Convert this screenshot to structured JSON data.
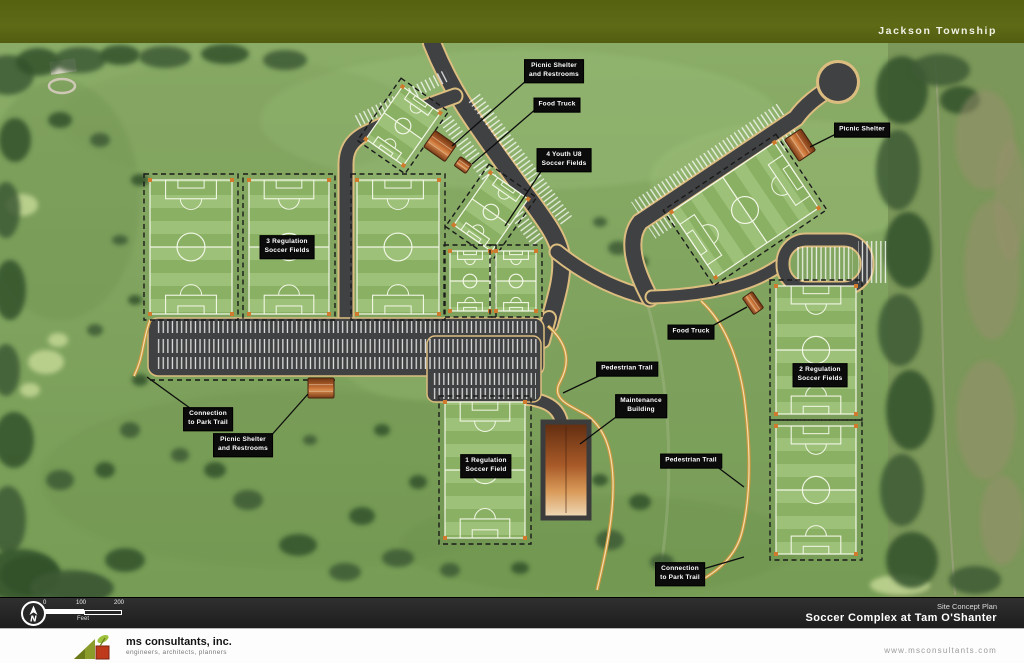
{
  "header": {
    "township_label": "Jackson Township"
  },
  "labels": {
    "picnic_shelter_restrooms_north": "Picnic Shelter\nand Restrooms",
    "food_truck_north": "Food Truck",
    "youth_u8_fields": "4 Youth U8\nSoccer Fields",
    "picnic_shelter_east": "Picnic Shelter",
    "regulation_fields_3": "3 Regulation\nSoccer Fields",
    "food_truck_east": "Food Truck",
    "regulation_fields_2": "2 Regulation\nSoccer Fields",
    "pedestrian_trail_mid": "Pedestrian Trail",
    "maintenance_building": "Maintenance\nBuilding",
    "pedestrian_trail_east": "Pedestrian Trail",
    "connection_park_trail_west": "Connection\nto Park Trail",
    "picnic_shelter_restrooms_west": "Picnic Shelter\nand Restrooms",
    "regulation_field_1": "1 Regulation\nSoccer Field",
    "connection_park_trail_south": "Connection\nto Park Trail"
  },
  "scale_bar": {
    "tick_zero": "0",
    "tick_hundred": "100",
    "tick_two_hundred": "200",
    "unit": "Feet",
    "north_letter": "N"
  },
  "title_block": {
    "plan_type": "Site Concept Plan",
    "project_name": "Soccer Complex at Tam O'Shanter"
  },
  "footer": {
    "company_name": "ms consultants, inc.",
    "company_tagline": "engineers, architects, planners",
    "website": "www.msconsultants.com"
  },
  "colors": {
    "header_olive": "#59641a",
    "road_gray": "#404142",
    "trail_tan": "#dcbd80",
    "label_bg": "#0b0b0b",
    "turf_light": "#9dc178",
    "turf_dark": "#8ab063"
  }
}
